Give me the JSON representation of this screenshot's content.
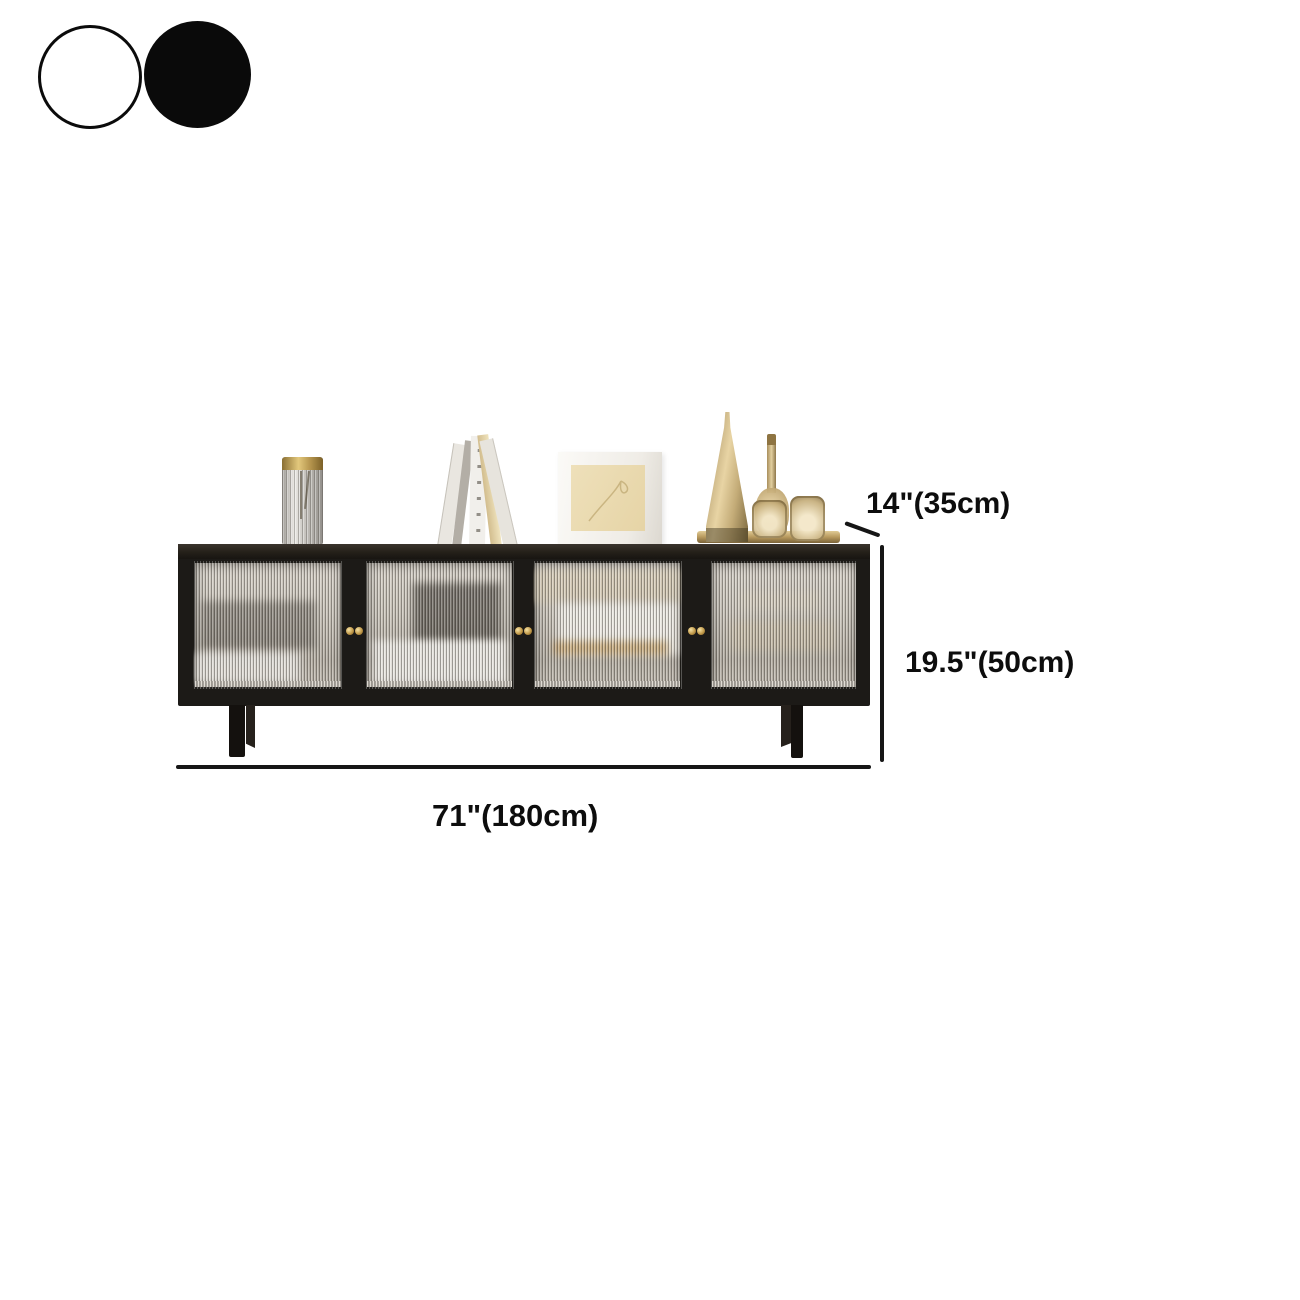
{
  "color_options": {
    "swatches": [
      {
        "name": "white",
        "color": "#ffffff",
        "border": "#0b0b0b"
      },
      {
        "name": "black",
        "color": "#0a0a0a",
        "border": "#0a0a0a"
      }
    ]
  },
  "dimensions": {
    "depth": "14\"(35cm)",
    "height": "19.5\"(50cm)",
    "width": "71\"(180cm)"
  },
  "product": {
    "door_count": "4",
    "knob_color": "#c29a4a",
    "frame_color": "#1c1a17",
    "annotation_color": "#161616"
  }
}
